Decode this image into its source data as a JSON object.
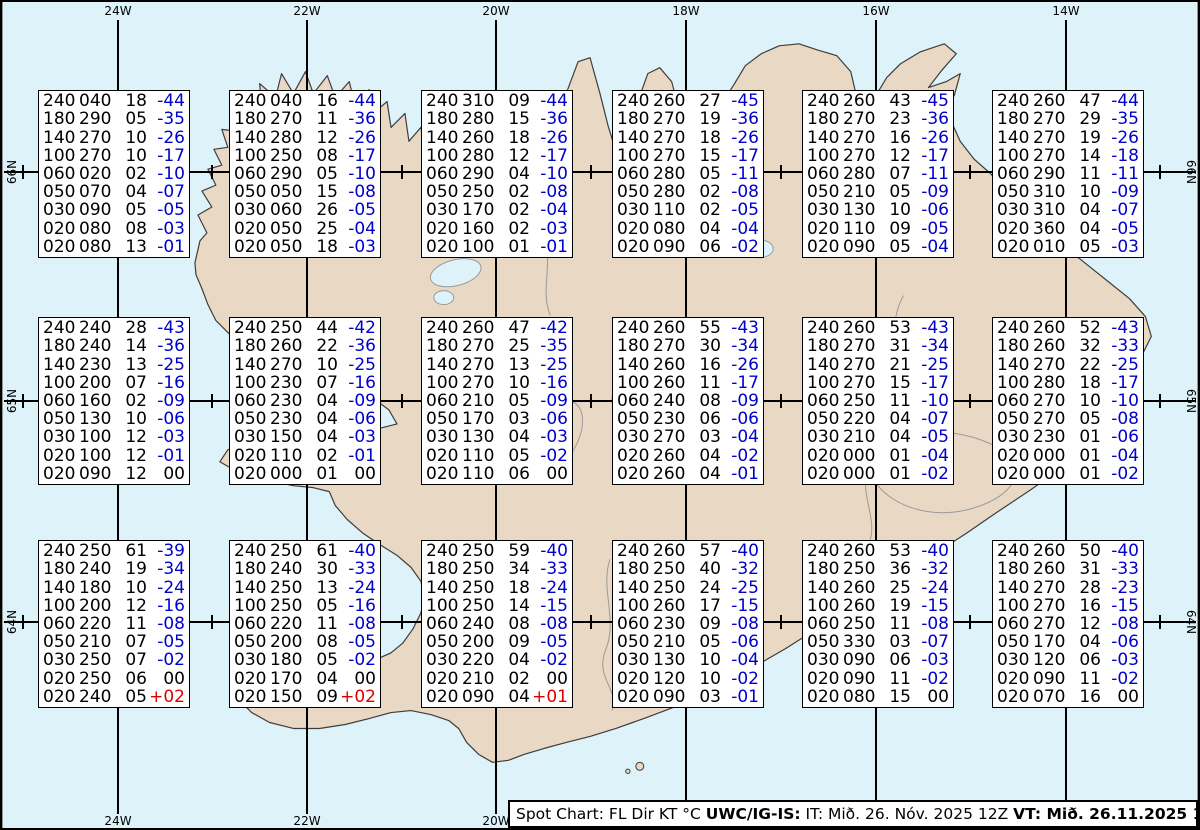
{
  "colors": {
    "ocean": "#ddf2f9",
    "land": "#e9d8c3",
    "coast": "#3d3d3d",
    "detail": "#9a9a9a",
    "grid": "#000000",
    "temp_negative": "#0000cc",
    "temp_positive": "#dd0000",
    "text": "#000000"
  },
  "grid": {
    "meridians": [
      {
        "label": "24W",
        "x": 116,
        "show_bottom": true
      },
      {
        "label": "22W",
        "x": 305,
        "show_bottom": true
      },
      {
        "label": "20W",
        "x": 494,
        "show_bottom": true
      },
      {
        "label": "18W",
        "x": 684,
        "show_bottom": false
      },
      {
        "label": "16W",
        "x": 874,
        "show_bottom": false
      },
      {
        "label": "14W",
        "x": 1064,
        "show_bottom": false
      }
    ],
    "parallels": [
      {
        "label": "66N",
        "y": 170
      },
      {
        "label": "65N",
        "y": 399
      },
      {
        "label": "64N",
        "y": 620
      }
    ],
    "tick_xs": [
      21,
      210,
      400,
      589,
      779,
      968,
      1158
    ]
  },
  "spot_boxes": {
    "columns_header": [
      "FL",
      "Dir",
      "KT",
      "°C"
    ],
    "col_x": [
      36,
      227,
      419,
      610,
      800,
      990
    ],
    "row_y": [
      88,
      315,
      538
    ],
    "width": 152,
    "height": 168,
    "boxes": [
      {
        "row": 0,
        "col": 0,
        "lines": [
          [
            "240",
            "040",
            "18",
            "-44"
          ],
          [
            "180",
            "290",
            "05",
            "-35"
          ],
          [
            "140",
            "270",
            "10",
            "-26"
          ],
          [
            "100",
            "270",
            "10",
            "-17"
          ],
          [
            "060",
            "020",
            "02",
            "-10"
          ],
          [
            "050",
            "070",
            "04",
            "-07"
          ],
          [
            "030",
            "090",
            "05",
            "-05"
          ],
          [
            "020",
            "080",
            "08",
            "-03"
          ],
          [
            "020",
            "080",
            "13",
            "-01"
          ]
        ]
      },
      {
        "row": 0,
        "col": 1,
        "lines": [
          [
            "240",
            "040",
            "16",
            "-44"
          ],
          [
            "180",
            "270",
            "11",
            "-36"
          ],
          [
            "140",
            "280",
            "12",
            "-26"
          ],
          [
            "100",
            "250",
            "08",
            "-17"
          ],
          [
            "060",
            "290",
            "05",
            "-10"
          ],
          [
            "050",
            "050",
            "15",
            "-08"
          ],
          [
            "030",
            "060",
            "26",
            "-05"
          ],
          [
            "020",
            "050",
            "25",
            "-04"
          ],
          [
            "020",
            "050",
            "18",
            "-03"
          ]
        ]
      },
      {
        "row": 0,
        "col": 2,
        "lines": [
          [
            "240",
            "310",
            "09",
            "-44"
          ],
          [
            "180",
            "280",
            "15",
            "-36"
          ],
          [
            "140",
            "260",
            "18",
            "-26"
          ],
          [
            "100",
            "280",
            "12",
            "-17"
          ],
          [
            "060",
            "290",
            "04",
            "-10"
          ],
          [
            "050",
            "250",
            "02",
            "-08"
          ],
          [
            "030",
            "170",
            "02",
            "-04"
          ],
          [
            "020",
            "160",
            "02",
            "-03"
          ],
          [
            "020",
            "100",
            "01",
            "-01"
          ]
        ]
      },
      {
        "row": 0,
        "col": 3,
        "lines": [
          [
            "240",
            "260",
            "27",
            "-45"
          ],
          [
            "180",
            "270",
            "19",
            "-36"
          ],
          [
            "140",
            "270",
            "18",
            "-26"
          ],
          [
            "100",
            "270",
            "15",
            "-17"
          ],
          [
            "060",
            "280",
            "05",
            "-11"
          ],
          [
            "050",
            "280",
            "02",
            "-08"
          ],
          [
            "030",
            "110",
            "02",
            "-05"
          ],
          [
            "020",
            "080",
            "04",
            "-04"
          ],
          [
            "020",
            "090",
            "06",
            "-02"
          ]
        ]
      },
      {
        "row": 0,
        "col": 4,
        "lines": [
          [
            "240",
            "260",
            "43",
            "-45"
          ],
          [
            "180",
            "270",
            "23",
            "-36"
          ],
          [
            "140",
            "270",
            "16",
            "-26"
          ],
          [
            "100",
            "270",
            "12",
            "-17"
          ],
          [
            "060",
            "280",
            "07",
            "-11"
          ],
          [
            "050",
            "210",
            "05",
            "-09"
          ],
          [
            "030",
            "130",
            "10",
            "-06"
          ],
          [
            "020",
            "110",
            "09",
            "-05"
          ],
          [
            "020",
            "090",
            "05",
            "-04"
          ]
        ]
      },
      {
        "row": 0,
        "col": 5,
        "lines": [
          [
            "240",
            "260",
            "47",
            "-44"
          ],
          [
            "180",
            "270",
            "29",
            "-35"
          ],
          [
            "140",
            "270",
            "19",
            "-26"
          ],
          [
            "100",
            "270",
            "14",
            "-18"
          ],
          [
            "060",
            "290",
            "11",
            "-11"
          ],
          [
            "050",
            "310",
            "10",
            "-09"
          ],
          [
            "030",
            "310",
            "04",
            "-07"
          ],
          [
            "020",
            "360",
            "04",
            "-05"
          ],
          [
            "020",
            "010",
            "05",
            "-03"
          ]
        ]
      },
      {
        "row": 1,
        "col": 0,
        "lines": [
          [
            "240",
            "240",
            "28",
            "-43"
          ],
          [
            "180",
            "240",
            "14",
            "-36"
          ],
          [
            "140",
            "230",
            "13",
            "-25"
          ],
          [
            "100",
            "200",
            "07",
            "-16"
          ],
          [
            "060",
            "160",
            "02",
            "-09"
          ],
          [
            "050",
            "130",
            "10",
            "-06"
          ],
          [
            "030",
            "100",
            "12",
            "-03"
          ],
          [
            "020",
            "100",
            "12",
            "-01"
          ],
          [
            "020",
            "090",
            "12",
            "00"
          ]
        ]
      },
      {
        "row": 1,
        "col": 1,
        "lines": [
          [
            "240",
            "250",
            "44",
            "-42"
          ],
          [
            "180",
            "260",
            "22",
            "-36"
          ],
          [
            "140",
            "270",
            "10",
            "-25"
          ],
          [
            "100",
            "230",
            "07",
            "-16"
          ],
          [
            "060",
            "230",
            "04",
            "-09"
          ],
          [
            "050",
            "230",
            "04",
            "-06"
          ],
          [
            "030",
            "150",
            "04",
            "-03"
          ],
          [
            "020",
            "110",
            "02",
            "-01"
          ],
          [
            "020",
            "000",
            "01",
            "00"
          ]
        ]
      },
      {
        "row": 1,
        "col": 2,
        "lines": [
          [
            "240",
            "260",
            "47",
            "-42"
          ],
          [
            "180",
            "270",
            "25",
            "-35"
          ],
          [
            "140",
            "270",
            "13",
            "-25"
          ],
          [
            "100",
            "270",
            "10",
            "-16"
          ],
          [
            "060",
            "210",
            "05",
            "-09"
          ],
          [
            "050",
            "170",
            "03",
            "-06"
          ],
          [
            "030",
            "130",
            "04",
            "-03"
          ],
          [
            "020",
            "110",
            "05",
            "-02"
          ],
          [
            "020",
            "110",
            "06",
            "00"
          ]
        ]
      },
      {
        "row": 1,
        "col": 3,
        "lines": [
          [
            "240",
            "260",
            "55",
            "-43"
          ],
          [
            "180",
            "270",
            "30",
            "-34"
          ],
          [
            "140",
            "260",
            "16",
            "-26"
          ],
          [
            "100",
            "260",
            "11",
            "-17"
          ],
          [
            "060",
            "240",
            "08",
            "-09"
          ],
          [
            "050",
            "230",
            "06",
            "-06"
          ],
          [
            "030",
            "270",
            "03",
            "-04"
          ],
          [
            "020",
            "260",
            "04",
            "-02"
          ],
          [
            "020",
            "260",
            "04",
            "-01"
          ]
        ]
      },
      {
        "row": 1,
        "col": 4,
        "lines": [
          [
            "240",
            "260",
            "53",
            "-43"
          ],
          [
            "180",
            "270",
            "31",
            "-34"
          ],
          [
            "140",
            "270",
            "21",
            "-25"
          ],
          [
            "100",
            "270",
            "15",
            "-17"
          ],
          [
            "060",
            "250",
            "11",
            "-10"
          ],
          [
            "050",
            "220",
            "04",
            "-07"
          ],
          [
            "030",
            "210",
            "04",
            "-05"
          ],
          [
            "020",
            "000",
            "01",
            "-04"
          ],
          [
            "020",
            "000",
            "01",
            "-02"
          ]
        ]
      },
      {
        "row": 1,
        "col": 5,
        "lines": [
          [
            "240",
            "260",
            "52",
            "-43"
          ],
          [
            "180",
            "260",
            "32",
            "-33"
          ],
          [
            "140",
            "270",
            "22",
            "-25"
          ],
          [
            "100",
            "280",
            "18",
            "-17"
          ],
          [
            "060",
            "270",
            "10",
            "-10"
          ],
          [
            "050",
            "270",
            "05",
            "-08"
          ],
          [
            "030",
            "230",
            "01",
            "-06"
          ],
          [
            "020",
            "000",
            "01",
            "-04"
          ],
          [
            "020",
            "000",
            "01",
            "-02"
          ]
        ]
      },
      {
        "row": 2,
        "col": 0,
        "lines": [
          [
            "240",
            "250",
            "61",
            "-39"
          ],
          [
            "180",
            "240",
            "19",
            "-34"
          ],
          [
            "140",
            "180",
            "10",
            "-24"
          ],
          [
            "100",
            "200",
            "12",
            "-16"
          ],
          [
            "060",
            "220",
            "11",
            "-08"
          ],
          [
            "050",
            "210",
            "07",
            "-05"
          ],
          [
            "030",
            "250",
            "07",
            "-02"
          ],
          [
            "020",
            "250",
            "06",
            "00"
          ],
          [
            "020",
            "240",
            "05",
            "+02"
          ]
        ]
      },
      {
        "row": 2,
        "col": 1,
        "lines": [
          [
            "240",
            "250",
            "61",
            "-40"
          ],
          [
            "180",
            "240",
            "30",
            "-33"
          ],
          [
            "140",
            "250",
            "13",
            "-24"
          ],
          [
            "100",
            "250",
            "05",
            "-16"
          ],
          [
            "060",
            "220",
            "11",
            "-08"
          ],
          [
            "050",
            "200",
            "08",
            "-05"
          ],
          [
            "030",
            "180",
            "05",
            "-02"
          ],
          [
            "020",
            "170",
            "04",
            "00"
          ],
          [
            "020",
            "150",
            "09",
            "+02"
          ]
        ]
      },
      {
        "row": 2,
        "col": 2,
        "lines": [
          [
            "240",
            "250",
            "59",
            "-40"
          ],
          [
            "180",
            "250",
            "34",
            "-33"
          ],
          [
            "140",
            "250",
            "18",
            "-24"
          ],
          [
            "100",
            "250",
            "14",
            "-15"
          ],
          [
            "060",
            "240",
            "08",
            "-08"
          ],
          [
            "050",
            "200",
            "09",
            "-05"
          ],
          [
            "030",
            "220",
            "04",
            "-02"
          ],
          [
            "020",
            "210",
            "02",
            "00"
          ],
          [
            "020",
            "090",
            "04",
            "+01"
          ]
        ]
      },
      {
        "row": 2,
        "col": 3,
        "lines": [
          [
            "240",
            "260",
            "57",
            "-40"
          ],
          [
            "180",
            "250",
            "40",
            "-32"
          ],
          [
            "140",
            "250",
            "24",
            "-25"
          ],
          [
            "100",
            "260",
            "17",
            "-15"
          ],
          [
            "060",
            "230",
            "09",
            "-08"
          ],
          [
            "050",
            "210",
            "05",
            "-06"
          ],
          [
            "030",
            "130",
            "10",
            "-04"
          ],
          [
            "020",
            "120",
            "10",
            "-02"
          ],
          [
            "020",
            "090",
            "03",
            "-01"
          ]
        ]
      },
      {
        "row": 2,
        "col": 4,
        "lines": [
          [
            "240",
            "260",
            "53",
            "-40"
          ],
          [
            "180",
            "250",
            "36",
            "-32"
          ],
          [
            "140",
            "260",
            "25",
            "-24"
          ],
          [
            "100",
            "260",
            "19",
            "-15"
          ],
          [
            "060",
            "250",
            "11",
            "-08"
          ],
          [
            "050",
            "330",
            "03",
            "-07"
          ],
          [
            "030",
            "090",
            "06",
            "-03"
          ],
          [
            "020",
            "090",
            "11",
            "-02"
          ],
          [
            "020",
            "080",
            "15",
            "00"
          ]
        ]
      },
      {
        "row": 2,
        "col": 5,
        "lines": [
          [
            "240",
            "260",
            "50",
            "-40"
          ],
          [
            "180",
            "260",
            "31",
            "-33"
          ],
          [
            "140",
            "270",
            "28",
            "-23"
          ],
          [
            "100",
            "270",
            "16",
            "-15"
          ],
          [
            "060",
            "270",
            "12",
            "-08"
          ],
          [
            "050",
            "170",
            "04",
            "-06"
          ],
          [
            "030",
            "120",
            "06",
            "-03"
          ],
          [
            "020",
            "090",
            "11",
            "-02"
          ],
          [
            "020",
            "070",
            "16",
            "00"
          ]
        ]
      }
    ]
  },
  "caption": {
    "segments": [
      {
        "text": "Spot Chart: FL Dir KT °C ",
        "bold": false
      },
      {
        "text": "UWC/IG-IS:",
        "bold": true
      },
      {
        "text": " IT: Mið. 26. Nóv. 2025 12Z ",
        "bold": false
      },
      {
        "text": "VT: Mið. 26.11.2025 18Z",
        "bold": true
      },
      {
        "text": " (+6 h)",
        "bold": false
      }
    ]
  }
}
